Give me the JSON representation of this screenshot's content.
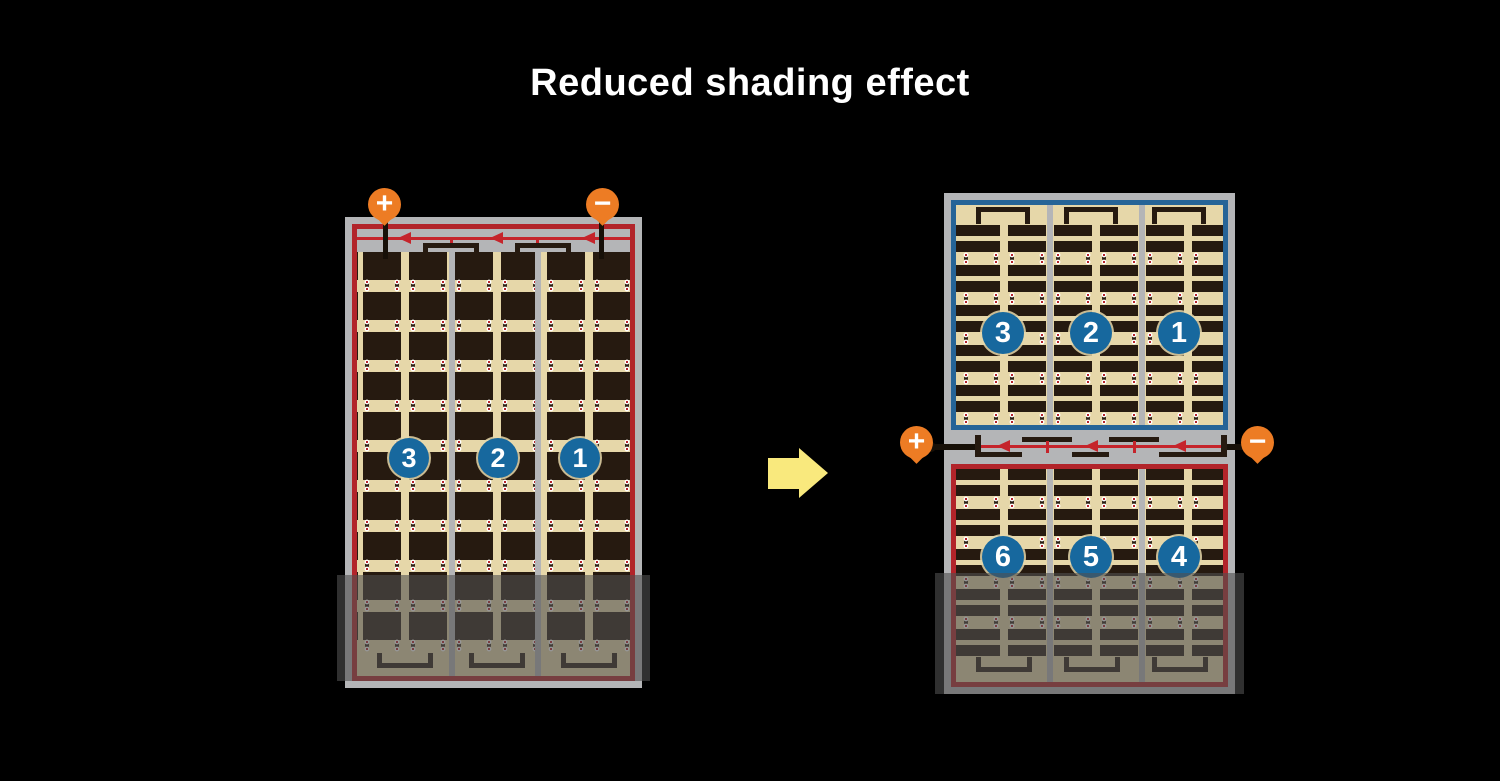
{
  "title": "Reduced shading effect",
  "colors": {
    "background": "#000000",
    "frame_gray": "#b4b5b7",
    "panel_tan": "#e6d7a9",
    "cell_dark": "#261a10",
    "red_border": "#b2242a",
    "diode_red": "#c5242b",
    "blue_border": "#266497",
    "badge_blue": "#17689e",
    "terminal_orange": "#ed7c24",
    "arrow_yellow": "#f9e97d",
    "dot_red": "#b6252b",
    "dot_white": "#ffffff",
    "shade_overlay": "rgba(80,80,80,0.6)"
  },
  "left_panel": {
    "terminals": {
      "plus": "+",
      "minus": "−"
    },
    "badges": [
      "3",
      "2",
      "1"
    ]
  },
  "right_panel": {
    "terminals": {
      "plus": "+",
      "minus": "−"
    },
    "top_badges": [
      "3",
      "2",
      "1"
    ],
    "bottom_badges": [
      "6",
      "5",
      "4"
    ]
  }
}
